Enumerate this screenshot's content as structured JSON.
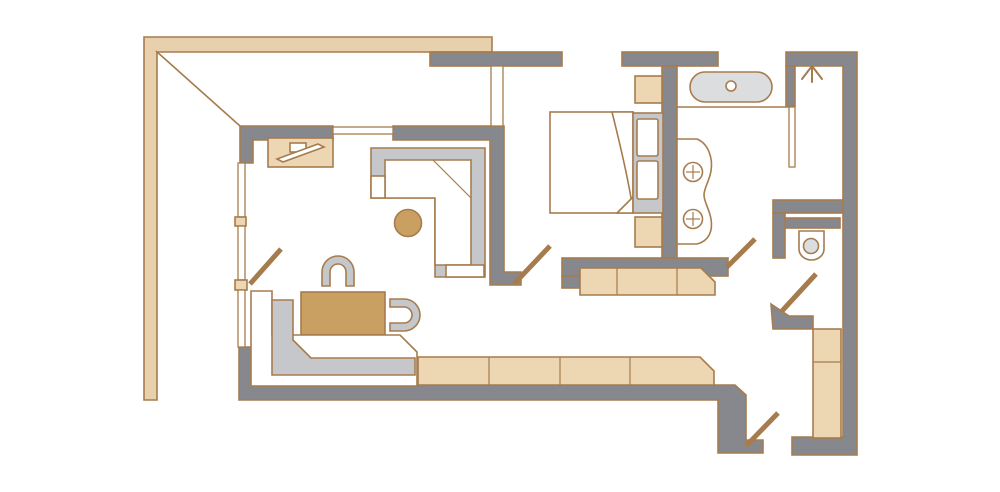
{
  "meta": {
    "description": "Hotel suite floor plan drawing, top-down view, no text labels",
    "width_px": 1000,
    "height_px": 492
  },
  "colors": {
    "background": "#ffffff",
    "wall": "#87888D",
    "outline": "#A67C4E",
    "wood_light": "#EDD6B2",
    "terrace": "#E7D0AB",
    "wood_dark": "#C99F62",
    "cushion": "#C6C7CA",
    "fixture": "#DCDDDF",
    "glass": "#ffffff"
  },
  "fixtures": [
    "terrace-band",
    "terrace-edge-diagonal",
    "living-room-walls",
    "window-top",
    "window-left",
    "tv-console",
    "tv-screen",
    "corner-sofa",
    "round-ottoman",
    "work-table",
    "chair-top",
    "chair-right",
    "daybed-sofa",
    "long-sideboard",
    "balcony-door",
    "bedroom-door",
    "corridor-door",
    "toilet-door",
    "entry-door",
    "bed-mattress",
    "duvet-fold",
    "headboard",
    "pillow",
    "nightstand-top",
    "nightstand-bottom",
    "bedroom-dresser",
    "bathtub",
    "tub-drain",
    "vanity-counter",
    "sink",
    "shower-glass",
    "shower-head-symbol",
    "toilet",
    "wardrobe"
  ]
}
